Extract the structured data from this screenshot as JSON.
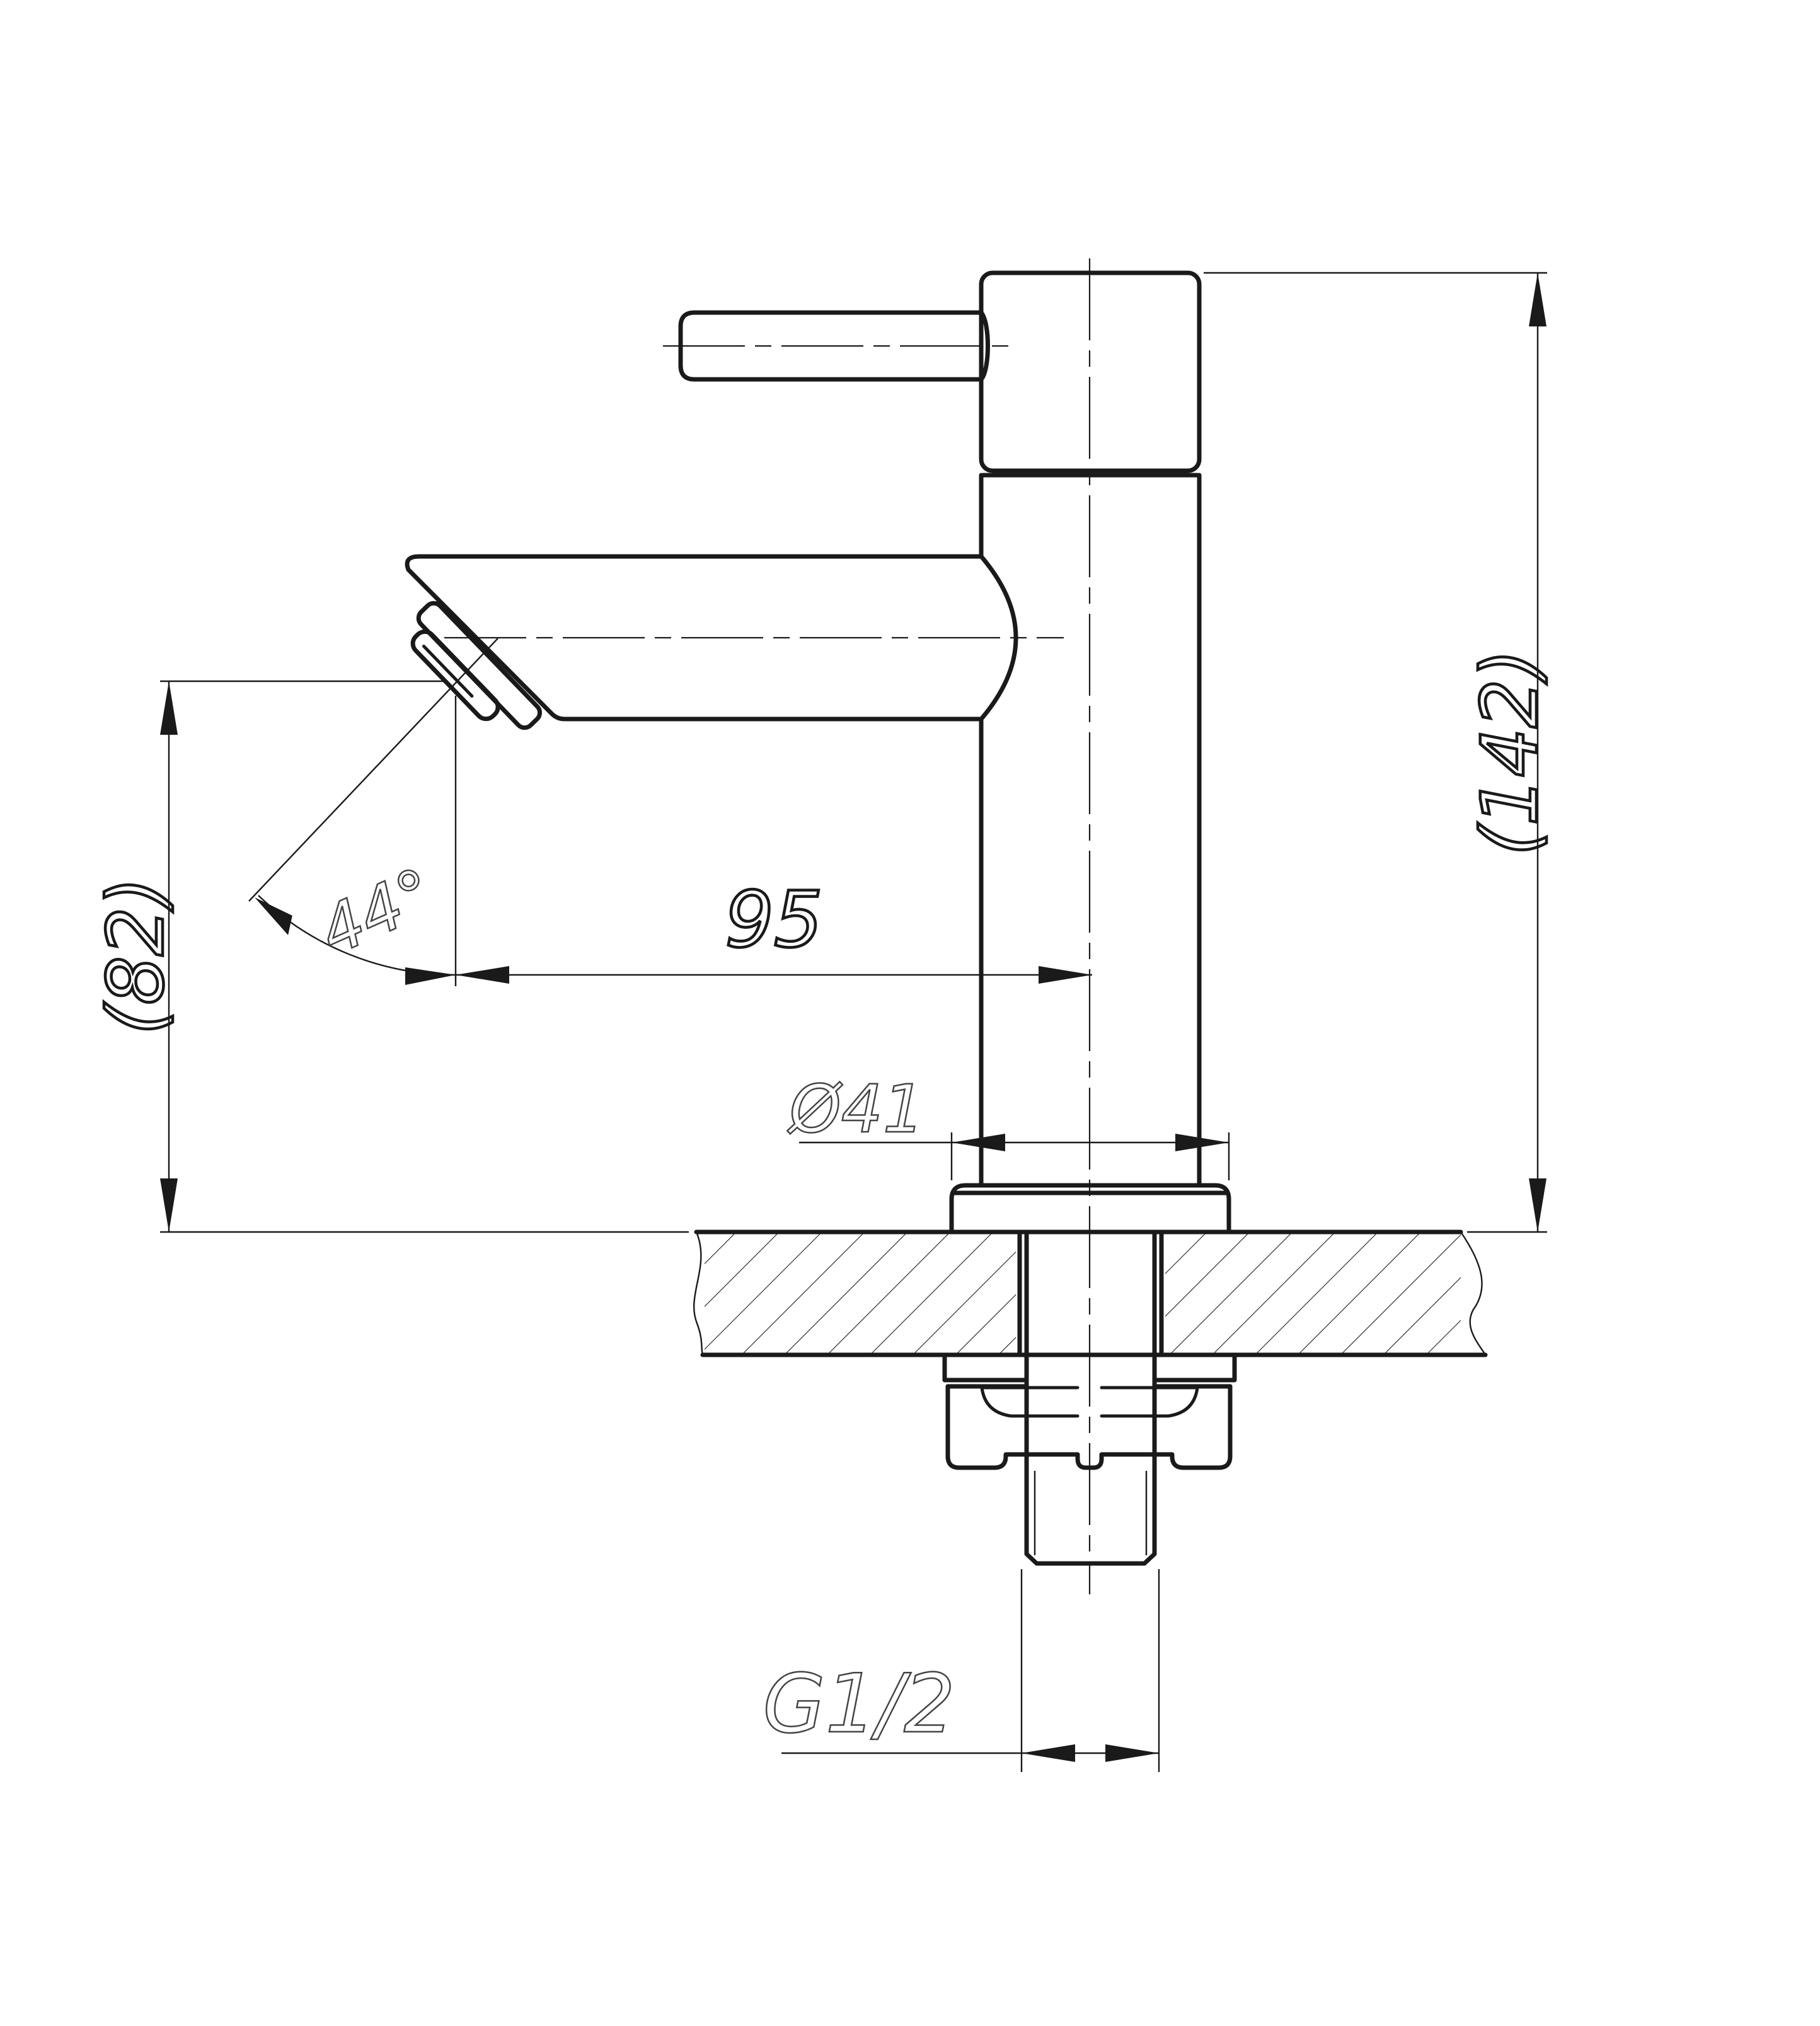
{
  "dimensions": {
    "overall_height": "(142)",
    "outlet_height": "(82)",
    "spout_reach": "95",
    "flange_diameter": "Ø41",
    "thread_size": "G1/2",
    "outlet_angle": "44°"
  },
  "colors": {
    "ink": "#1a1a1a",
    "dim_text_light": "#444444",
    "background": "#ffffff"
  }
}
